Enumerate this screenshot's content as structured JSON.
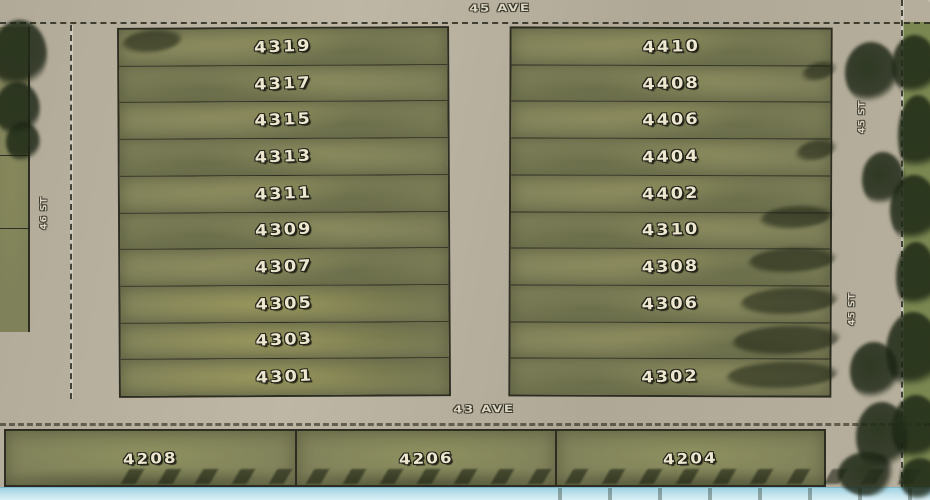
{
  "streets": {
    "top_avenue": "45 AVE",
    "bottom_avenue": "43 AVE",
    "left_street": "46 ST",
    "right_street": "45 ST"
  },
  "blocks": {
    "west_lots": [
      "4319",
      "4317",
      "4315",
      "4313",
      "4311",
      "4309",
      "4307",
      "4305",
      "4303",
      "4301"
    ],
    "east_lots": [
      "4410",
      "4408",
      "4406",
      "4404",
      "4402",
      "4310",
      "4308",
      "4306",
      "",
      "4302"
    ],
    "south_lots": [
      "4208",
      "4206",
      "4204"
    ]
  },
  "colors": {
    "road": "#b7af9d",
    "road_light": "#c6beac",
    "grass": "#7f815a",
    "grass_light": "#a09c66",
    "boundary": "#2d2d21",
    "label_fill": "#ede7d0",
    "label_outline": "#22221a",
    "tree": "#26331c",
    "greenbelt": "#7a8751",
    "water_strip": "#c3e4ee"
  }
}
